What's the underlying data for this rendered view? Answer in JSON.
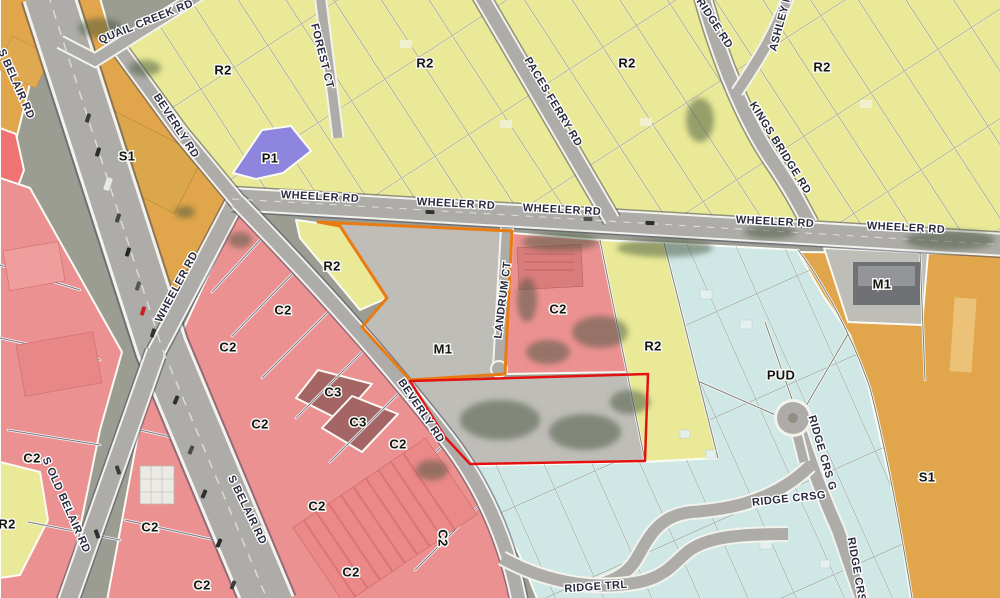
{
  "map": {
    "colors": {
      "r2_yellow": "#e9e997",
      "s1_orange": "#e1a64b",
      "c2_red": "#ec9191",
      "c2_red_bright": "#f07272",
      "c3_maroon": "#a56565",
      "p1_purple": "#8e86de",
      "pud_cyan": "#cfe8e6",
      "m1_gray": "#bfbdb8",
      "road": "#aeaca8",
      "selection_orange": "#e87b12",
      "selection_red": "#e21212",
      "parcel_line": "#4a4a66",
      "label": "#151515",
      "road_label": "#2b2b40",
      "halo": "#f7f7f2",
      "tree": "#44543c",
      "base": "#9b9d92"
    },
    "zone_labels": [
      {
        "t": "R2",
        "x": 223,
        "y": 70
      },
      {
        "t": "R2",
        "x": 425,
        "y": 63
      },
      {
        "t": "R2",
        "x": 627,
        "y": 63
      },
      {
        "t": "R2",
        "x": 822,
        "y": 67
      },
      {
        "t": "S1",
        "x": 127,
        "y": 156
      },
      {
        "t": "P1",
        "x": 270,
        "y": 158
      },
      {
        "t": "R2",
        "x": 332,
        "y": 266
      },
      {
        "t": "M1",
        "x": 443,
        "y": 349
      },
      {
        "t": "C2",
        "x": 558,
        "y": 309
      },
      {
        "t": "R2",
        "x": 653,
        "y": 346
      },
      {
        "t": "PUD",
        "x": 781,
        "y": 375
      },
      {
        "t": "M1",
        "x": 882,
        "y": 284
      },
      {
        "t": "S1",
        "x": 927,
        "y": 477
      },
      {
        "t": "C2",
        "x": 283,
        "y": 310
      },
      {
        "t": "C2",
        "x": 228,
        "y": 347
      },
      {
        "t": "C2",
        "x": 260,
        "y": 424
      },
      {
        "t": "C3",
        "x": 333,
        "y": 392
      },
      {
        "t": "C3",
        "x": 358,
        "y": 422
      },
      {
        "t": "C2",
        "x": 398,
        "y": 444
      },
      {
        "t": "C2",
        "x": 32,
        "y": 458
      },
      {
        "t": "R2",
        "x": 7,
        "y": 524
      },
      {
        "t": "C2",
        "x": 150,
        "y": 527
      },
      {
        "t": "C2",
        "x": 202,
        "y": 585
      },
      {
        "t": "C2",
        "x": 317,
        "y": 506
      },
      {
        "t": "C2",
        "x": 351,
        "y": 572
      },
      {
        "t": "C2",
        "x": 443,
        "y": 538,
        "r": 90
      }
    ],
    "road_labels": [
      {
        "t": "S BELAIR RD",
        "x": 16,
        "y": 84,
        "r": 66
      },
      {
        "t": "QUAIL CREEK RD",
        "x": 146,
        "y": 22,
        "r": -22
      },
      {
        "t": "BEVERLY RD",
        "x": 176,
        "y": 126,
        "r": 57
      },
      {
        "t": "FOREST CT",
        "x": 322,
        "y": 56,
        "r": 76
      },
      {
        "t": "PACES FERRY RD",
        "x": 553,
        "y": 102,
        "r": 59
      },
      {
        "t": "BRIDGE RD",
        "x": 712,
        "y": 20,
        "r": 57
      },
      {
        "t": "ASHLEY M",
        "x": 781,
        "y": 22,
        "r": -75
      },
      {
        "t": "KINGS BRIDGE RD",
        "x": 780,
        "y": 148,
        "r": 58
      },
      {
        "t": "WHEELER RD",
        "x": 320,
        "y": 197,
        "r": 3
      },
      {
        "t": "WHEELER RD",
        "x": 456,
        "y": 204,
        "r": 3
      },
      {
        "t": "WHEELER RD",
        "x": 562,
        "y": 210,
        "r": 3
      },
      {
        "t": "WHEELER RD",
        "x": 775,
        "y": 222,
        "r": 3
      },
      {
        "t": "WHEELER RD",
        "x": 906,
        "y": 228,
        "r": 3
      },
      {
        "t": "WHEELER RD",
        "x": 177,
        "y": 287,
        "r": -62
      },
      {
        "t": "LANDRUM CT",
        "x": 503,
        "y": 300,
        "r": -83
      },
      {
        "t": "BEVERLY RD",
        "x": 421,
        "y": 411,
        "r": 56
      },
      {
        "t": "S OLD BELAIR RD",
        "x": 66,
        "y": 505,
        "r": 66
      },
      {
        "t": "S BELAIR RD",
        "x": 247,
        "y": 510,
        "r": 64
      },
      {
        "t": "RIDGE CRS G",
        "x": 822,
        "y": 453,
        "r": 74
      },
      {
        "t": "RIDGE CRSG",
        "x": 789,
        "y": 499,
        "r": -6
      },
      {
        "t": "RIDGE CRSG",
        "x": 857,
        "y": 574,
        "r": 80
      },
      {
        "t": "RIDGE TRL",
        "x": 596,
        "y": 587,
        "r": -4
      }
    ]
  }
}
